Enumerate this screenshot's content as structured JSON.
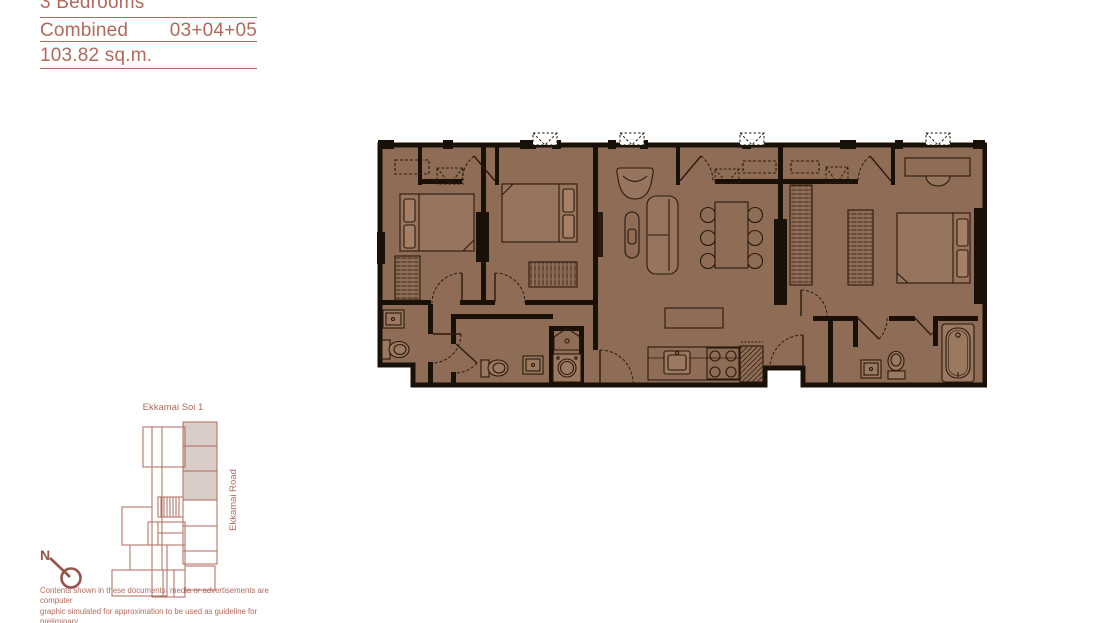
{
  "title_block": {
    "type": "3 Bedrooms",
    "layout": "Combined",
    "units": "03+04+05",
    "area": "103.82 sq.m."
  },
  "key_plan": {
    "street_top": "Ekkamai Soi 1",
    "street_right": "Ekkamai Road",
    "north_label": "N"
  },
  "disclaimer": {
    "line1": "Contents shown in these documents, media or advertisements are computer",
    "line2": "graphic simulated for approximation to be used as guideline for preliminary",
    "line3": "consideration. The company owns the right to change without prior notice"
  },
  "colors": {
    "accent": "#b2695d",
    "floor_fill": "#8e6c56",
    "wall": "#191008",
    "furniture_line": "#2a1a0e",
    "highlighted_unit_fill": "#d9cec7",
    "compass": "#96544a"
  }
}
